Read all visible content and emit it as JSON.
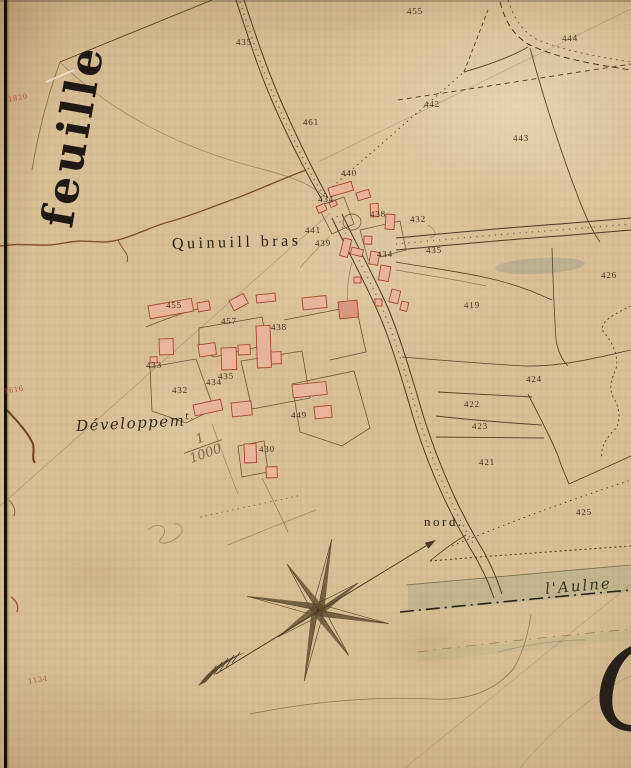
{
  "map": {
    "sheet_label": "feuille",
    "place_name": "Quinuill bras",
    "inset_label": "Développem",
    "inset_label_sup": "t.",
    "scale_numerator": "1",
    "scale_denominator": "1000",
    "north_label": "nord.",
    "river_label": "l'Aulne",
    "corner_letter": "C"
  },
  "colors": {
    "paper": "#d9bf96",
    "ink": "#54422c",
    "building_fill": "#e8b49c",
    "building_stroke": "#a8492e",
    "red_mark": "#b53a24",
    "river_tint": "#9aa486"
  },
  "edge_marks": [
    {
      "text": "1820",
      "x": 8,
      "y": 94,
      "color": "#b53a24"
    },
    {
      "text": "1616",
      "x": 4,
      "y": 386,
      "color": "#b53a24"
    },
    {
      "text": "1134",
      "x": 28,
      "y": 676,
      "color": "#a0522d"
    }
  ],
  "parcels": [
    {
      "num": "455",
      "x": 407,
      "y": 6
    },
    {
      "num": "435",
      "x": 236,
      "y": 37
    },
    {
      "num": "444",
      "x": 562,
      "y": 33
    },
    {
      "num": "442",
      "x": 424,
      "y": 99
    },
    {
      "num": "461",
      "x": 303,
      "y": 117
    },
    {
      "num": "443",
      "x": 513,
      "y": 133
    },
    {
      "num": "440",
      "x": 341,
      "y": 168
    },
    {
      "num": "434",
      "x": 318,
      "y": 194
    },
    {
      "num": "438",
      "x": 370,
      "y": 209
    },
    {
      "num": "432",
      "x": 410,
      "y": 214
    },
    {
      "num": "441",
      "x": 305,
      "y": 225
    },
    {
      "num": "439",
      "x": 315,
      "y": 238
    },
    {
      "num": "434",
      "x": 377,
      "y": 249
    },
    {
      "num": "435",
      "x": 426,
      "y": 245
    },
    {
      "num": "426",
      "x": 601,
      "y": 270
    },
    {
      "num": "419",
      "x": 464,
      "y": 300
    },
    {
      "num": "455",
      "x": 166,
      "y": 300
    },
    {
      "num": "457",
      "x": 221,
      "y": 316
    },
    {
      "num": "438",
      "x": 271,
      "y": 322
    },
    {
      "num": "433",
      "x": 146,
      "y": 360
    },
    {
      "num": "435",
      "x": 218,
      "y": 371
    },
    {
      "num": "434",
      "x": 206,
      "y": 377
    },
    {
      "num": "432",
      "x": 172,
      "y": 385
    },
    {
      "num": "424",
      "x": 526,
      "y": 374
    },
    {
      "num": "422",
      "x": 464,
      "y": 399
    },
    {
      "num": "449",
      "x": 291,
      "y": 410
    },
    {
      "num": "423",
      "x": 472,
      "y": 421
    },
    {
      "num": "430",
      "x": 259,
      "y": 444
    },
    {
      "num": "421",
      "x": 479,
      "y": 457
    },
    {
      "num": "425",
      "x": 576,
      "y": 507
    }
  ]
}
